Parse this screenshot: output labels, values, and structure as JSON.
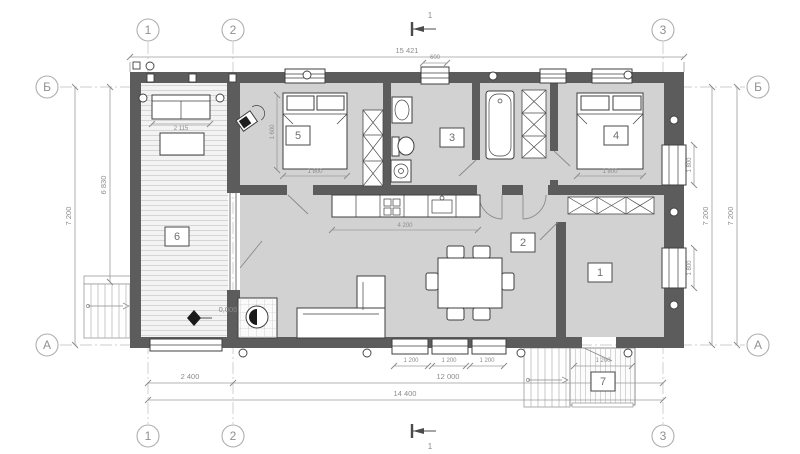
{
  "plan": {
    "axes": {
      "v": [
        "1",
        "2",
        "3"
      ],
      "h": [
        "Б",
        "А"
      ]
    },
    "section": {
      "label": "1"
    },
    "rooms": {
      "r1": "1",
      "r2": "2",
      "r3": "3",
      "r4": "4",
      "r5": "5",
      "r6": "6",
      "r7": "7"
    },
    "dims": {
      "top_overall": "15 421",
      "left_outer": "7 200",
      "left_inner": "6 830",
      "right_a": "7 200",
      "right_b": "7 200",
      "bottom_1_2": "2 400",
      "bottom_2_3": "12 000",
      "bottom_overall": "14 400",
      "bed5": "1 800",
      "bed4": "1 800",
      "room5_depth": "1 600",
      "sofa": "2 115",
      "window_top": "600",
      "kitchen": "4 200",
      "win_b1": "1 200",
      "win_b2": "1 200",
      "win_b3": "1 200",
      "deck": "1 200",
      "win_r1": "1 800",
      "win_r2": "1 800",
      "elevation": "0,000"
    },
    "colors": {
      "wall": "#5c5c5c",
      "floor": "#d2d2d2",
      "terrace": "#f3f3f3"
    }
  }
}
